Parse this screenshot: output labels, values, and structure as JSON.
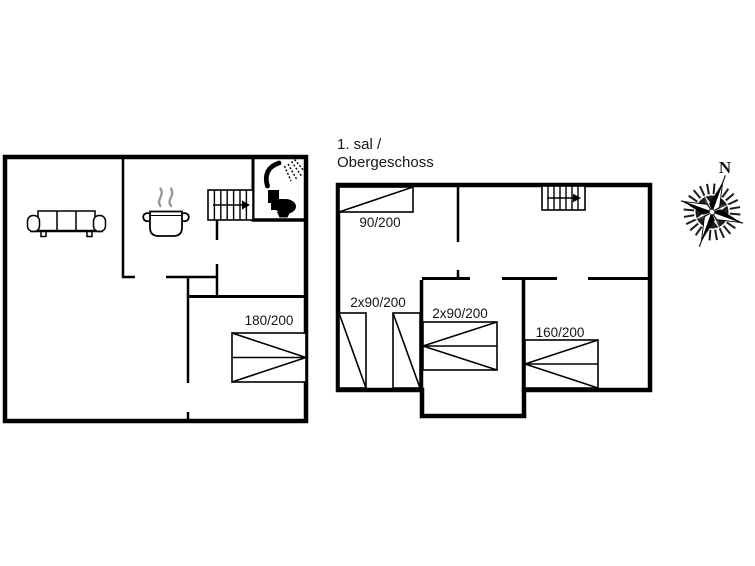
{
  "colors": {
    "background": "#ffffff",
    "walls": "#000000",
    "text": "#161616",
    "steam": "#9a9a9a"
  },
  "upper_floor_title": {
    "line1": "1. sal /",
    "line2": "Obergeschoss"
  },
  "compass": {
    "north_label": "N"
  },
  "ground_floor": {
    "bed_labels": [
      "180/200"
    ],
    "furniture_icons": [
      "sofa",
      "cooking-pot",
      "staircase-up-arrow",
      "shower",
      "toilet",
      "double-bed-180x200"
    ]
  },
  "upper_floor": {
    "bed_labels": [
      "90/200",
      "2x90/200",
      "2x90/200",
      "160/200"
    ],
    "furniture_icons": [
      "single-bed-90x200",
      "staircase-up-arrow",
      "two-single-beds-90x200",
      "double-bed-2x90x200",
      "double-bed-160x200"
    ]
  }
}
